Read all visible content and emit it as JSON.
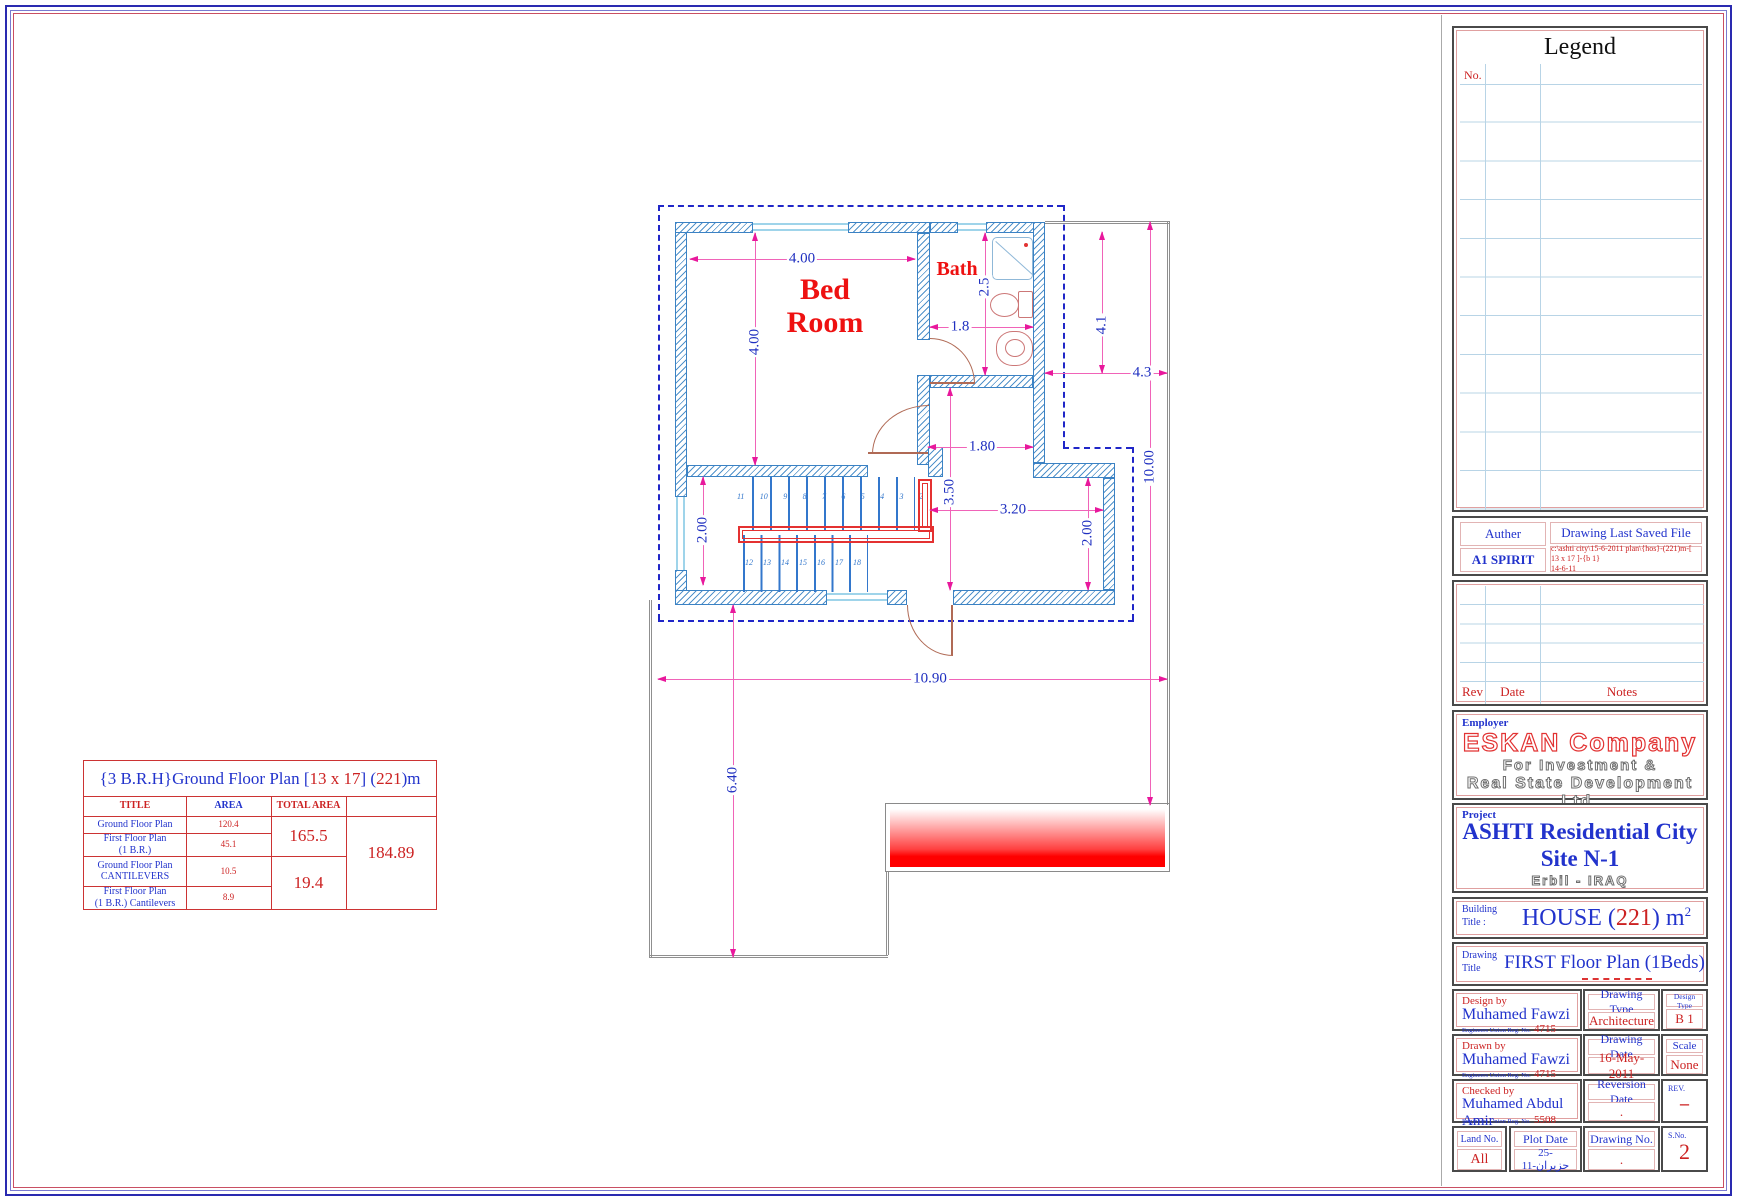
{
  "legend": {
    "title": "Legend",
    "no_label": "No."
  },
  "author_block": {
    "author_label": "Auther",
    "author_value": "A1 SPIRIT",
    "file_label": "Drawing Last Saved File",
    "file_line1": "c:\\ashti city\\15-6-2011 plan\\{hos}-(221)m-[ 13 x 17 ]-{b 1}",
    "file_line2": "14-6-11"
  },
  "rev_table": {
    "rev": "Rev",
    "date": "Date",
    "notes": "Notes"
  },
  "employer": {
    "label": "Employer",
    "line1": "ESKAN Company",
    "line2": "For Investment &",
    "line3": "Real State Development Ltd."
  },
  "project": {
    "label": "Project",
    "line1": "ASHTI Residential City",
    "line2": "Site N-1",
    "line3": "Erbil - IRAQ"
  },
  "building": {
    "label_l1": "Building",
    "label_l2": "Title :",
    "pre": "HOUSE (",
    "num": "221",
    "post": ") m",
    "sup": "2"
  },
  "drawing": {
    "label_l1": "Drawing",
    "label_l2": "Title",
    "value": "FIRST Floor Plan (1Beds)"
  },
  "tb": {
    "design_by_label": "Design by",
    "design_by": "Muhamed Fawzi",
    "reg_label": "Engineers Union Reg. No.",
    "design_reg": "4715",
    "drawing_type_label": "Drawing Type",
    "drawing_type": "Architecture",
    "design_type_label": "Design Type",
    "design_type": "B 1",
    "drawn_by_label": "Drawn by",
    "drawn_by": "Muhamed Fawzi",
    "drawn_reg": "4715",
    "drawing_date_label": "Drawing Date",
    "drawing_date": "16-May-2011",
    "scale_label": "Scale",
    "scale": "None",
    "checked_by_label": "Checked by",
    "checked_by": "Muhamed Abdul Amir",
    "checked_reg": "5508",
    "reversion_date_label": "Reversion Date",
    "reversion_date": ".",
    "rev_label": "REV.",
    "rev": "–",
    "land_no_label": "Land  No.",
    "land_no": "All",
    "plot_date_label": "Plot Date",
    "plot_date": "25-حزيران-11",
    "drawing_no_label": "Drawing No.",
    "drawing_no": ".",
    "sno_label": "S.No.",
    "sno": "2"
  },
  "area_table": {
    "t1": "{3 B.R.H}",
    "t2": " Ground Floor Plan [",
    "t3": "13 x 17",
    "t4": " ] (",
    "t5": "221",
    "t6": ")m",
    "h_title": "TITLE",
    "h_area": "AREA",
    "h_total": "TOTAL AREA",
    "r1_title": "Ground Floor Plan",
    "r1_area": "120.4",
    "r2_title1": "First Floor Plan",
    "r2_title2": "(1 B.R.)",
    "r2_area": "45.1",
    "r3_title1": "Ground Floor Plan",
    "r3_title2": "CANTILEVERS",
    "r3_area": "10.5",
    "r4_title1": "First Floor Plan",
    "r4_title2": "(1 B.R.) Cantilevers",
    "r4_area": "8.9",
    "sub1": "165.5",
    "sub2": "19.4",
    "grand": "184.89"
  },
  "plan": {
    "bedroom_l1": "Bed",
    "bedroom_l2": "Room",
    "bath": "Bath",
    "dims": {
      "bed_w": "4.00",
      "bed_h": "4.00",
      "bath_h": "2.5",
      "bath_door": "1.8",
      "upper_right": "4.1",
      "right_w": "4.3",
      "corridor": "1.80",
      "hall_h": "3.50",
      "hall_w": "3.20",
      "stair_w": "2.00",
      "hall_right": "2.00",
      "total_h": "10.00",
      "total_w": "10.90",
      "terrace_h": "6.40"
    },
    "stairs_up": [
      "11",
      "10",
      "9",
      "8",
      "7",
      "6",
      "5",
      "4",
      "3",
      "2"
    ],
    "stairs_down": [
      "12",
      "13",
      "14",
      "15",
      "16",
      "17",
      "18"
    ]
  }
}
